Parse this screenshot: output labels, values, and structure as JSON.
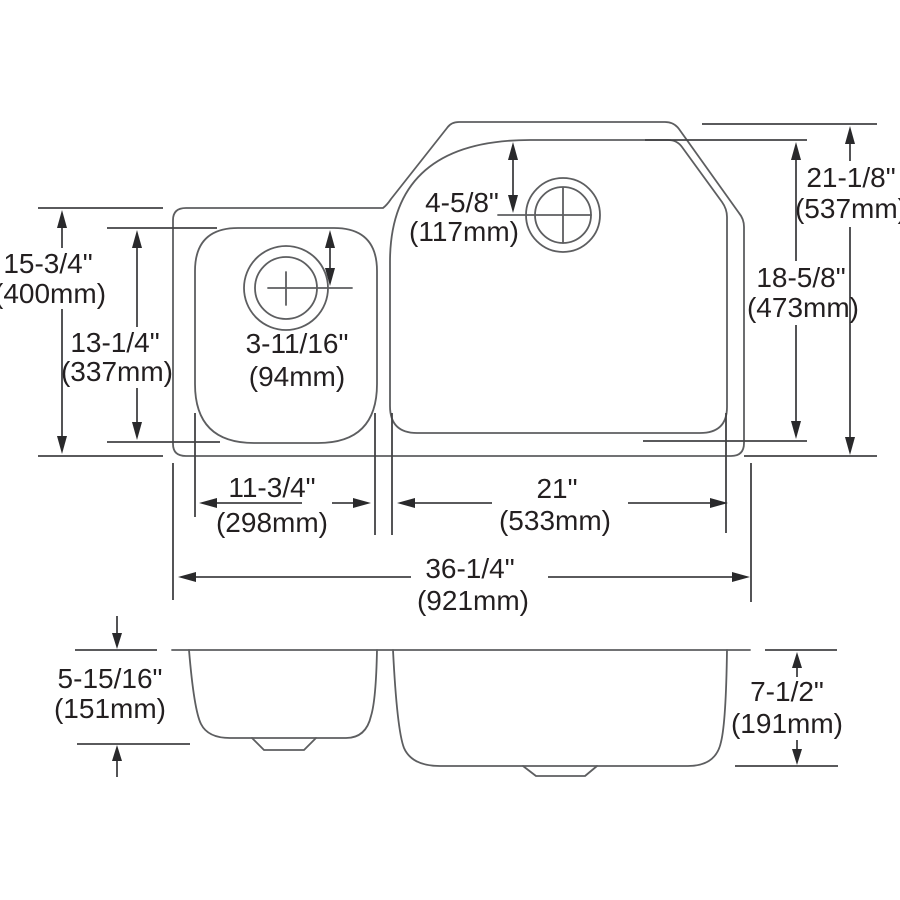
{
  "diagram": {
    "type": "sink-specification-drawing",
    "views": {
      "top_view": "plan view of offset double-bowl sink",
      "front_view": "elevation showing bowl depths"
    },
    "colors": {
      "background": "#ffffff",
      "outline": "#5d5e60",
      "dimension_lines": "#424244",
      "text": "#231f20"
    },
    "dims": {
      "left_overall": {
        "in": "15-3/4\"",
        "mm": "(400mm)"
      },
      "left_bowl": {
        "in": "13-1/4\"",
        "mm": "(337mm)"
      },
      "small_drain": {
        "in": "3-11/16\"",
        "mm": "(94mm)"
      },
      "large_drain": {
        "in": "4-5/8\"",
        "mm": "(117mm)"
      },
      "right_overall": {
        "in": "21-1/8\"",
        "mm": "(537mm)"
      },
      "right_bowl": {
        "in": "18-5/8\"",
        "mm": "(473mm)"
      },
      "small_bowl_width": {
        "in": "11-3/4\"",
        "mm": "(298mm)"
      },
      "large_bowl_width": {
        "in": "21\"",
        "mm": "(533mm)"
      },
      "overall_width": {
        "in": "36-1/4\"",
        "mm": "(921mm)"
      },
      "small_bowl_depth": {
        "in": "5-15/16\"",
        "mm": "(151mm)"
      },
      "large_bowl_depth": {
        "in": "7-1/2\"",
        "mm": "(191mm)"
      }
    }
  }
}
